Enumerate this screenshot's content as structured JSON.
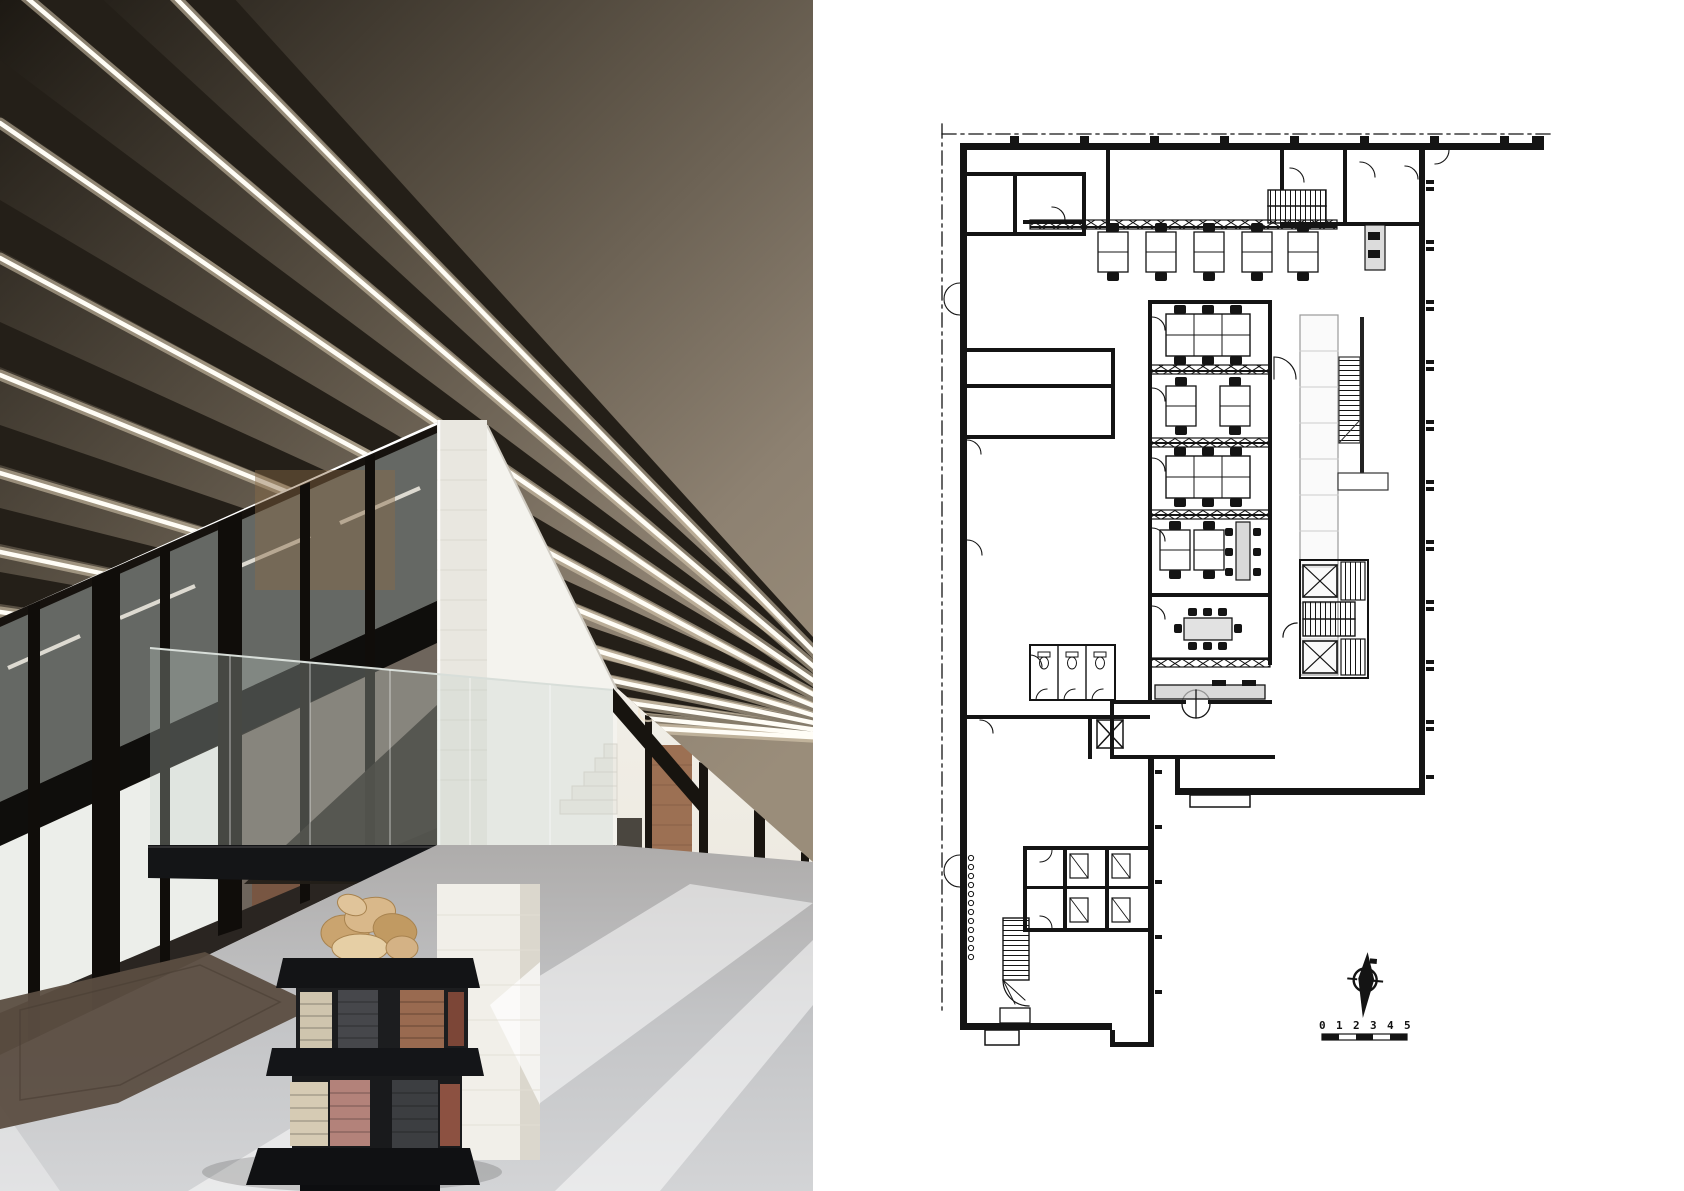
{
  "page": {
    "background": "#ffffff",
    "layout": "architecture-spread: interior photograph left, ground floor plan right"
  },
  "photo": {
    "subject": "industrial office interior with concrete beam ceiling, linear lights, glazed offices, white brick stair wall and brick-stack pedestal sculpture",
    "palette": {
      "ceiling_dark": "#241f18",
      "ceiling_panel": "#8d8171",
      "led_strip": "#fff6e8",
      "steel_black": "#15120e",
      "white_wall": "#f2f1ea",
      "floor_concrete": "#c3c4c6",
      "rug_brown": "#5b4d41",
      "brick_red": "#9a6a50",
      "brick_cream": "#d2c7b0",
      "sculpture_wood": "#d4b285"
    }
  },
  "plan": {
    "type": "architectural ground floor plan",
    "line_color": "#141414",
    "counter_fill": "#f4f4f4",
    "scale_bar": {
      "labels": [
        "0",
        "1",
        "2",
        "3",
        "4",
        "5"
      ]
    },
    "symbols": [
      "north-arrow",
      "door-swing-arcs",
      "stair-hatch",
      "elevator-x-box",
      "desk-clusters",
      "meeting-table",
      "wc-fixtures",
      "glass-partition-x-band",
      "dash-dot-boundary"
    ]
  }
}
